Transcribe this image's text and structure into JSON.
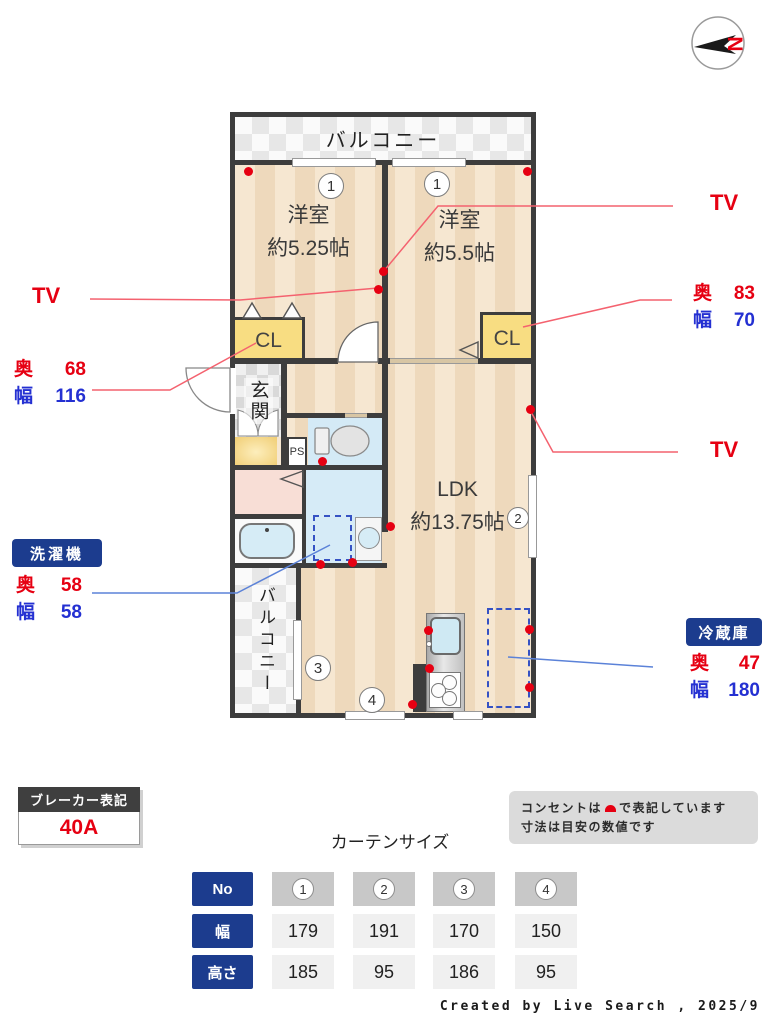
{
  "compass": {
    "letter": "N"
  },
  "plan": {
    "balcony_top": "バルコニー",
    "balcony_left": "バルコニー",
    "bedroom_left": {
      "name": "洋室",
      "size": "約5.25帖"
    },
    "bedroom_right": {
      "name": "洋室",
      "size": "約5.5帖"
    },
    "closet_left": "CL",
    "closet_right": "CL",
    "entrance": "玄関",
    "pipe_space": "PS",
    "ldk": {
      "name": "LDK",
      "size": "約13.75帖"
    },
    "window_numbers": [
      "1",
      "1",
      "2",
      "3",
      "4"
    ]
  },
  "annotations": {
    "tv_left": "TV",
    "tv_right_top": "TV",
    "tv_right_middle": "TV",
    "closet_left": {
      "depth_label": "奥",
      "depth_value": "68",
      "width_label": "幅",
      "width_value": "116"
    },
    "closet_right": {
      "depth_label": "奥",
      "depth_value": "83",
      "width_label": "幅",
      "width_value": "70"
    },
    "washer": {
      "label": "洗濯機",
      "depth_label": "奥",
      "depth_value": "58",
      "width_label": "幅",
      "width_value": "58"
    },
    "fridge": {
      "label": "冷蔵庫",
      "depth_label": "奥",
      "depth_value": "47",
      "width_label": "幅",
      "width_value": "180"
    }
  },
  "breaker": {
    "title": "ブレーカー表記",
    "value": "40A"
  },
  "note": {
    "line1_before": "コンセントは",
    "line1_after": "で表記しています",
    "line2": "寸法は目安の数値です"
  },
  "curtain_table": {
    "type": "table",
    "title": "カーテンサイズ",
    "row_headers": [
      "No",
      "幅",
      "高さ"
    ],
    "columns": [
      "1",
      "2",
      "3",
      "4"
    ],
    "widths": [
      "179",
      "191",
      "170",
      "150"
    ],
    "heights": [
      "185",
      "95",
      "186",
      "95"
    ]
  },
  "credit": "Created by Live Search , 2025/9",
  "colors": {
    "accent_red": "#e60012",
    "accent_blue": "#2430d2",
    "navy": "#1c3c8e",
    "wall": "#3d3d3d",
    "leader_red": "#f4626f",
    "leader_blue": "#5b82d8",
    "floor_light": "#f6e7d1",
    "floor_dark": "#eed9bc",
    "closet_yellow": "#f8dd82",
    "wet_area_blue": "#d6ebf7",
    "washroom_pink": "#f8ded6"
  }
}
